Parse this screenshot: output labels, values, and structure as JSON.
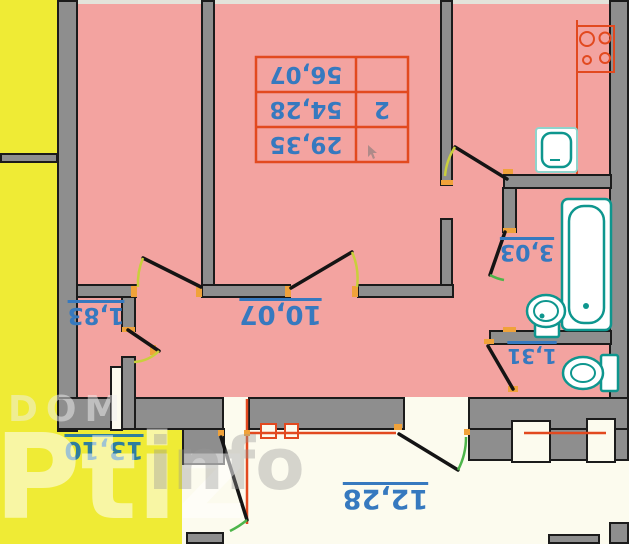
{
  "area_table": {
    "rooms_count": "2",
    "rows": [
      "56,07",
      "54,28",
      "29,35"
    ]
  },
  "labels": {
    "hallway": "10,07",
    "closet": "1,83",
    "bathroom": "3,03",
    "wc": "1,31",
    "terrace": "13,10",
    "balcony": "12,28"
  },
  "watermarks": {
    "dom": "DOM",
    "ptiz": "Ptiz",
    "info": "info"
  },
  "colors": {
    "floor_pink": "#f3a3a0",
    "outside_yellow": "#efeb35",
    "wall_gray": "#8e8e8e",
    "label_blue": "#3679bf",
    "terrace_label_blue": "#2e7d9e",
    "fixture_teal": "#0e968e",
    "line_orange": "#e2491f",
    "arc_yellow": "#c9cf3b",
    "arc_green": "#4db54a",
    "balcony_white": "#fcfbee"
  }
}
